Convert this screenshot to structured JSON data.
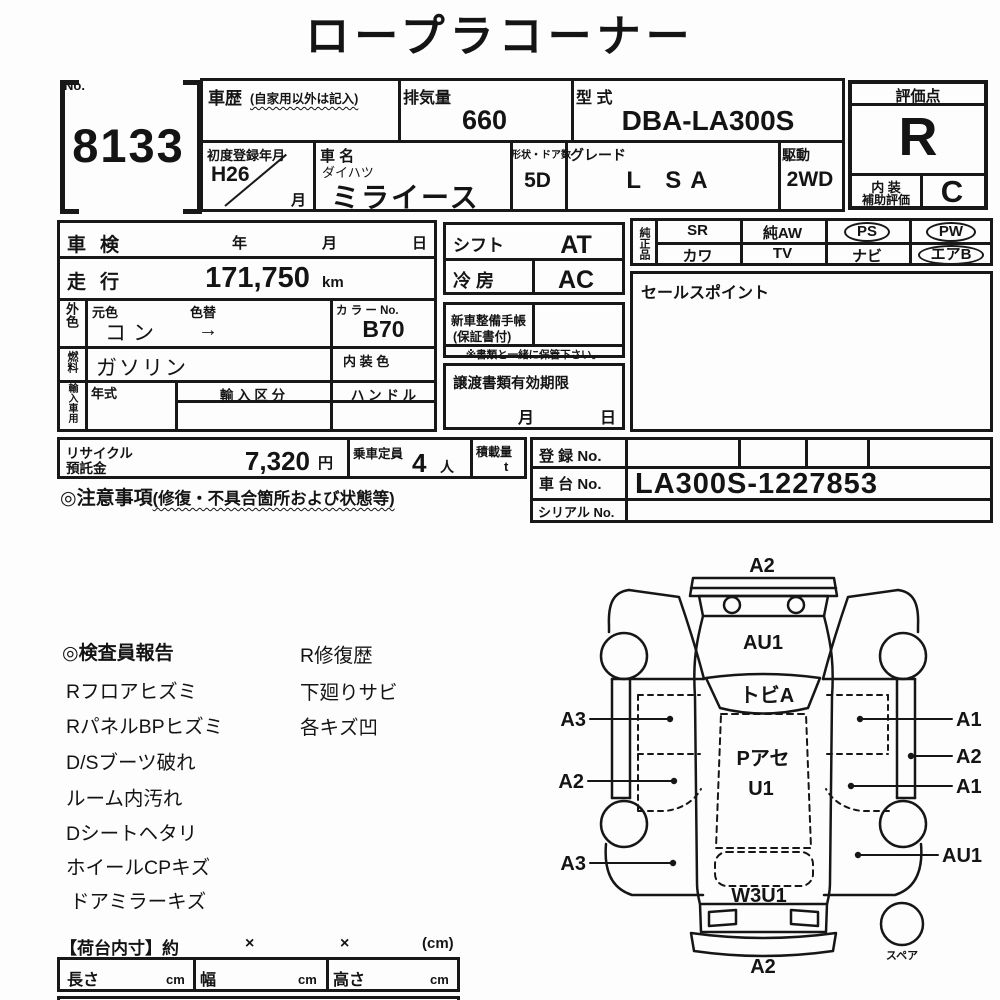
{
  "title": "ロープラコーナー",
  "header": {
    "no_label": "No.",
    "auction_no": "8133",
    "history": {
      "label": "車歴",
      "note": "(自家用以外は記入)"
    },
    "displacement": {
      "label": "排気量",
      "value": "660"
    },
    "model_code": {
      "label": "型 式",
      "value": "DBA-LA300S"
    },
    "first_reg": {
      "label": "初度登録年月",
      "value": "H26",
      "month": "月"
    },
    "car_name": {
      "label": "車 名",
      "maker": "ダイハツ",
      "value": "ミライース"
    },
    "body_doors": {
      "label": "形状・ドア数",
      "value": "5D"
    },
    "grade": {
      "label": "グレード",
      "value": "L SA"
    },
    "drive": {
      "label": "駆動",
      "value": "2WD"
    },
    "score": {
      "label": "評価点",
      "value": "R",
      "interior_label_1": "内 装",
      "interior_label_2": "補助評価",
      "interior_value": "C"
    }
  },
  "details": {
    "shaken": {
      "label": "車検",
      "year": "年",
      "month": "月",
      "day": "日"
    },
    "mileage": {
      "label": "走行",
      "value": "171,750",
      "unit": "km"
    },
    "ext_color": {
      "label": "外色",
      "orig_label": "元色",
      "change_label": "色替",
      "value": "コン",
      "arrow": "→"
    },
    "color_no": {
      "label": "カ ラ ー No.",
      "value": "B70"
    },
    "fuel": {
      "label": "燃料",
      "value": "ガソリン"
    },
    "int_color_label": "内 装 色",
    "import": {
      "label": "輸入車用",
      "year_label": "年式",
      "class_label": "輸 入 区 分",
      "handle_label": "ハ ン ド ル"
    }
  },
  "mid": {
    "shift": {
      "label": "シフト",
      "value": "AT"
    },
    "ac": {
      "label": "冷 房",
      "value": "AC"
    },
    "service_book": {
      "label_1": "新車整備手帳",
      "label_2": "(保証書付)",
      "note": "※書類と一緒に保管下さい。"
    },
    "transfer": {
      "label": "譲渡書類有効期限",
      "month": "月",
      "day": "日"
    }
  },
  "equipment": {
    "label": "純正品",
    "items": [
      {
        "label": "SR",
        "circled": false
      },
      {
        "label": "純AW",
        "circled": false
      },
      {
        "label": "PS",
        "circled": true
      },
      {
        "label": "PW",
        "circled": true
      },
      {
        "label": "カワ",
        "circled": false
      },
      {
        "label": "TV",
        "circled": false
      },
      {
        "label": "ナビ",
        "circled": false
      },
      {
        "label": "エアB",
        "circled": true
      }
    ],
    "sales_point_label": "セールスポイント"
  },
  "recycle": {
    "label_1": "リサイクル",
    "label_2": "預託金",
    "value": "7,320",
    "unit": "円",
    "capacity": {
      "label": "乗車定員",
      "value": "4",
      "unit": "人"
    },
    "load": {
      "label": "積載量",
      "unit": "t"
    }
  },
  "caution": {
    "heading": "◎注意事項",
    "note": "(修復・不具合箇所および状態等)"
  },
  "registration": {
    "reg_no_label": "登 録 No.",
    "chassis_label": "車 台 No.",
    "chassis_value": "LA300S-1227853",
    "serial_label": "シリアル No."
  },
  "inspector_report": {
    "heading": "◎検査員報告",
    "col1": [
      "Rフロアヒズミ",
      "RパネルBPヒズミ",
      "D/Sブーツ破れ",
      "ルーム内汚れ",
      "Dシートヘタリ",
      "ホイールCPキズ",
      "ドアミラーキズ"
    ],
    "col2": [
      "R修復歴",
      "下廻りサビ",
      "各キズ凹"
    ]
  },
  "diagram": {
    "front_top": "A2",
    "hood": "AU1",
    "windshield": "トビA",
    "roof_1": "Pアセ",
    "roof_2": "U1",
    "rear": "W3U1",
    "rear_bottom": "A2",
    "left": [
      "A3",
      "A2",
      "A3"
    ],
    "right": [
      "A1",
      "A2",
      "A1",
      "AU1"
    ],
    "spare": "スペア"
  },
  "cargo": {
    "heading": "【荷台内寸】約",
    "times_1": "×",
    "times_2": "×",
    "unit": "(cm)",
    "length_label": "長さ",
    "width_label": "幅",
    "height_label": "高さ",
    "cm": "cm"
  }
}
